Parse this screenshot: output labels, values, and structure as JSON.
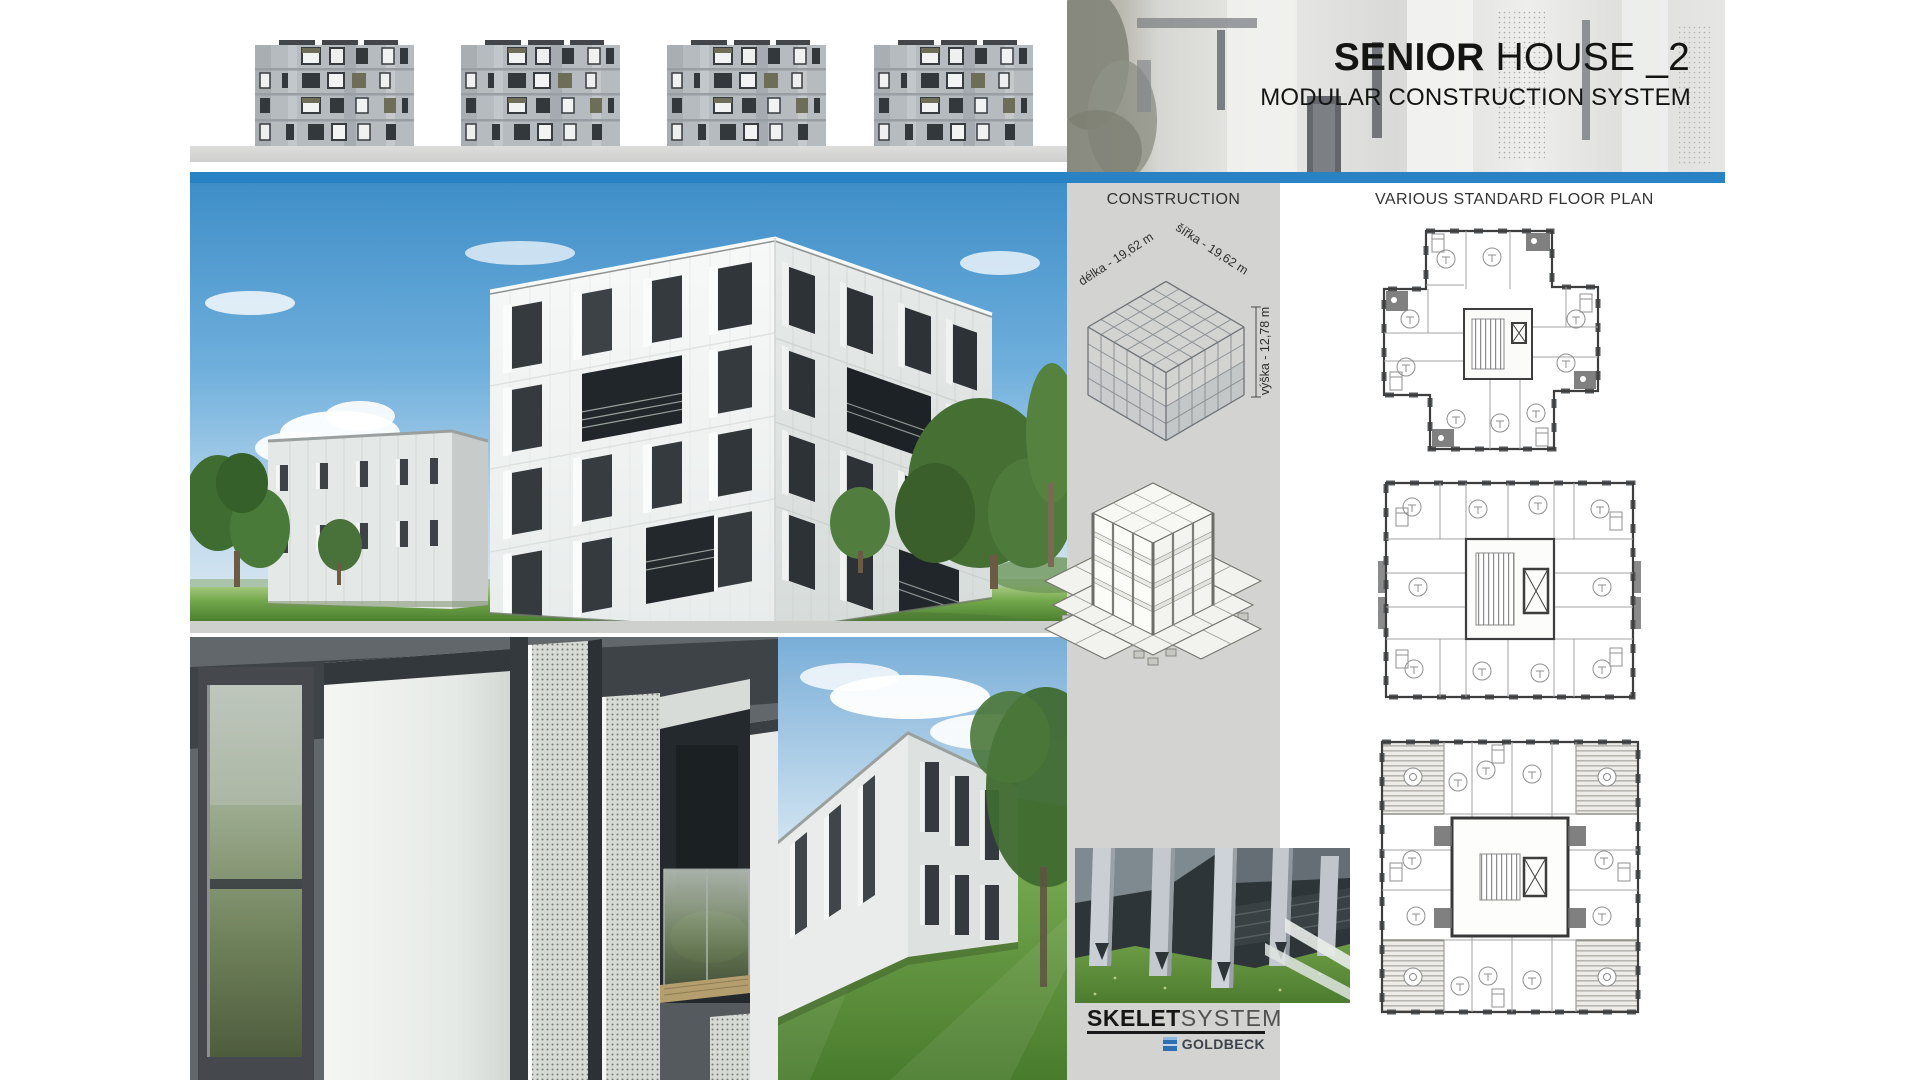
{
  "header": {
    "title_bold": "SENIOR",
    "title_rest": " HOUSE _2",
    "subtitle": "MODULAR CONSTRUCTION SYSTEM"
  },
  "construction": {
    "heading": "CONSTRUCTION",
    "dim_length": "délka - 19,62 m",
    "dim_width": "šířka - 19,62 m",
    "dim_height": "výška - 12,78 m"
  },
  "floor_plans": {
    "heading": "VARIOUS STANDARD FLOOR PLAN",
    "count": 3
  },
  "branding": {
    "brand_bold": "SKELET",
    "brand_light": "SYSTEM",
    "partner": "GOLDBECK"
  },
  "elevations": {
    "count": 4
  },
  "colors": {
    "accent_blue": "#2882c3",
    "column_gray": "#d3d3d1",
    "ground_strip_gray": "#d8d8d6",
    "sky_blue": "#5ea5d8",
    "grass_green": "#6aa243"
  }
}
